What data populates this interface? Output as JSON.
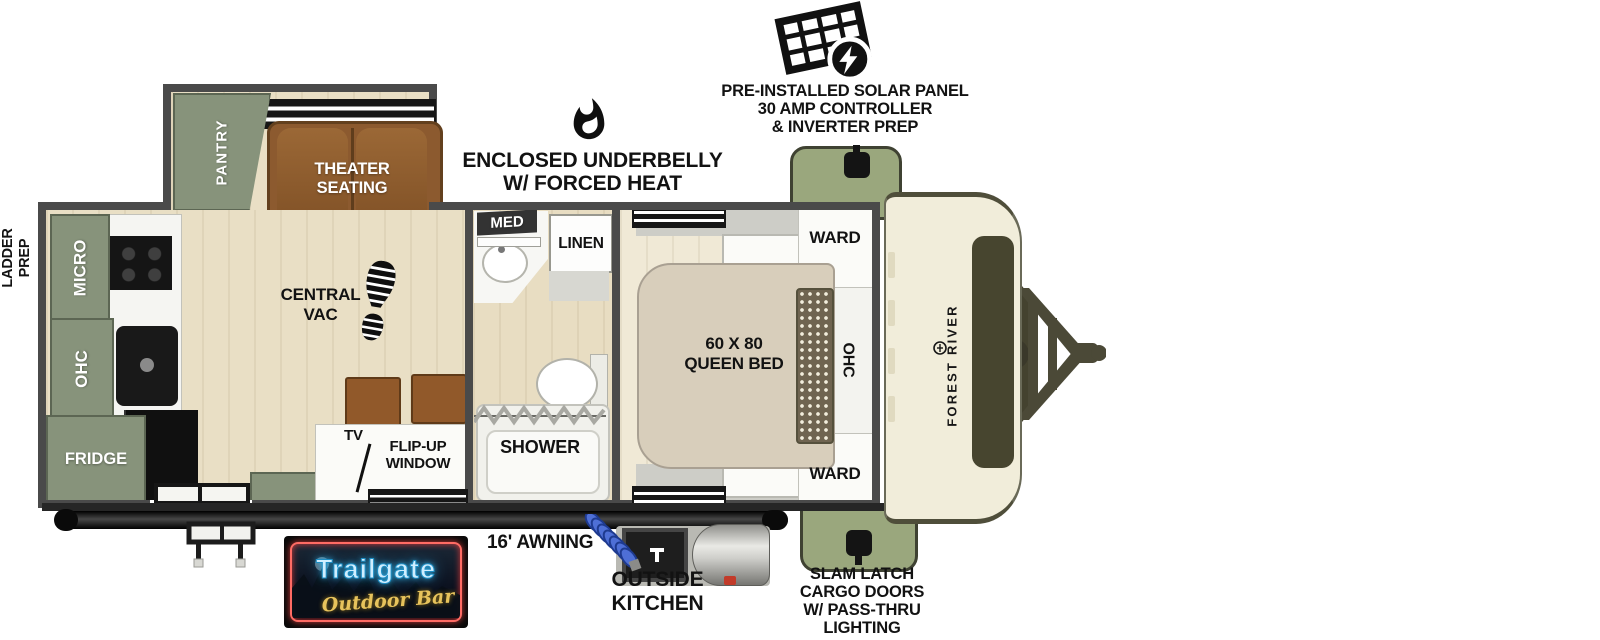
{
  "callouts": {
    "solar": {
      "lines": [
        "PRE-INSTALLED SOLAR PANEL",
        "30 AMP CONTROLLER",
        "& INVERTER PREP"
      ]
    },
    "underbelly": {
      "lines": [
        "ENCLOSED UNDERBELLY",
        "W/ FORCED HEAT"
      ]
    },
    "ladder": {
      "lines": [
        "LADDER",
        "PREP"
      ]
    },
    "awning": "16' AWNING",
    "outside_kitchen": {
      "lines": [
        "OUTSIDE",
        "KITCHEN"
      ]
    },
    "slam_latch": {
      "lines": [
        "SLAM LATCH",
        "CARGO DOORS",
        "W/ PASS-THRU",
        "LIGHTING"
      ]
    }
  },
  "rooms": {
    "pantry": "PANTRY",
    "theater": {
      "lines": [
        "THEATER",
        "SEATING"
      ]
    },
    "micro": "MICRO",
    "ohc_kitchen": "OHC",
    "fridge": "FRIDGE",
    "central_vac": {
      "lines": [
        "CENTRAL",
        "VAC"
      ]
    },
    "tv": "TV",
    "flip_up": {
      "lines": [
        "FLIP-UP",
        "WINDOW"
      ]
    },
    "med": "MED",
    "linen": "LINEN",
    "shower": "SHOWER",
    "bed": {
      "lines": [
        "60 X 80",
        "QUEEN BED"
      ]
    },
    "ward_top": "WARD",
    "ohc_bedroom": "OHC",
    "ward_bottom": "WARD"
  },
  "brand": {
    "name": "FOREST RIVER"
  },
  "logo": {
    "title": "Trailgate",
    "subtitle": "Outdoor Bar"
  },
  "colors": {
    "cabinet_green": "#87937b",
    "cargo_olive": "#9aa77d",
    "sofa_brown": "#8c5a2f",
    "bed_tan": "#d8cebb",
    "cap_cream": "#f1edda",
    "neon_blue": "#bfe9ff",
    "neon_red": "#ff6b64",
    "gold": "#e7c35c"
  }
}
